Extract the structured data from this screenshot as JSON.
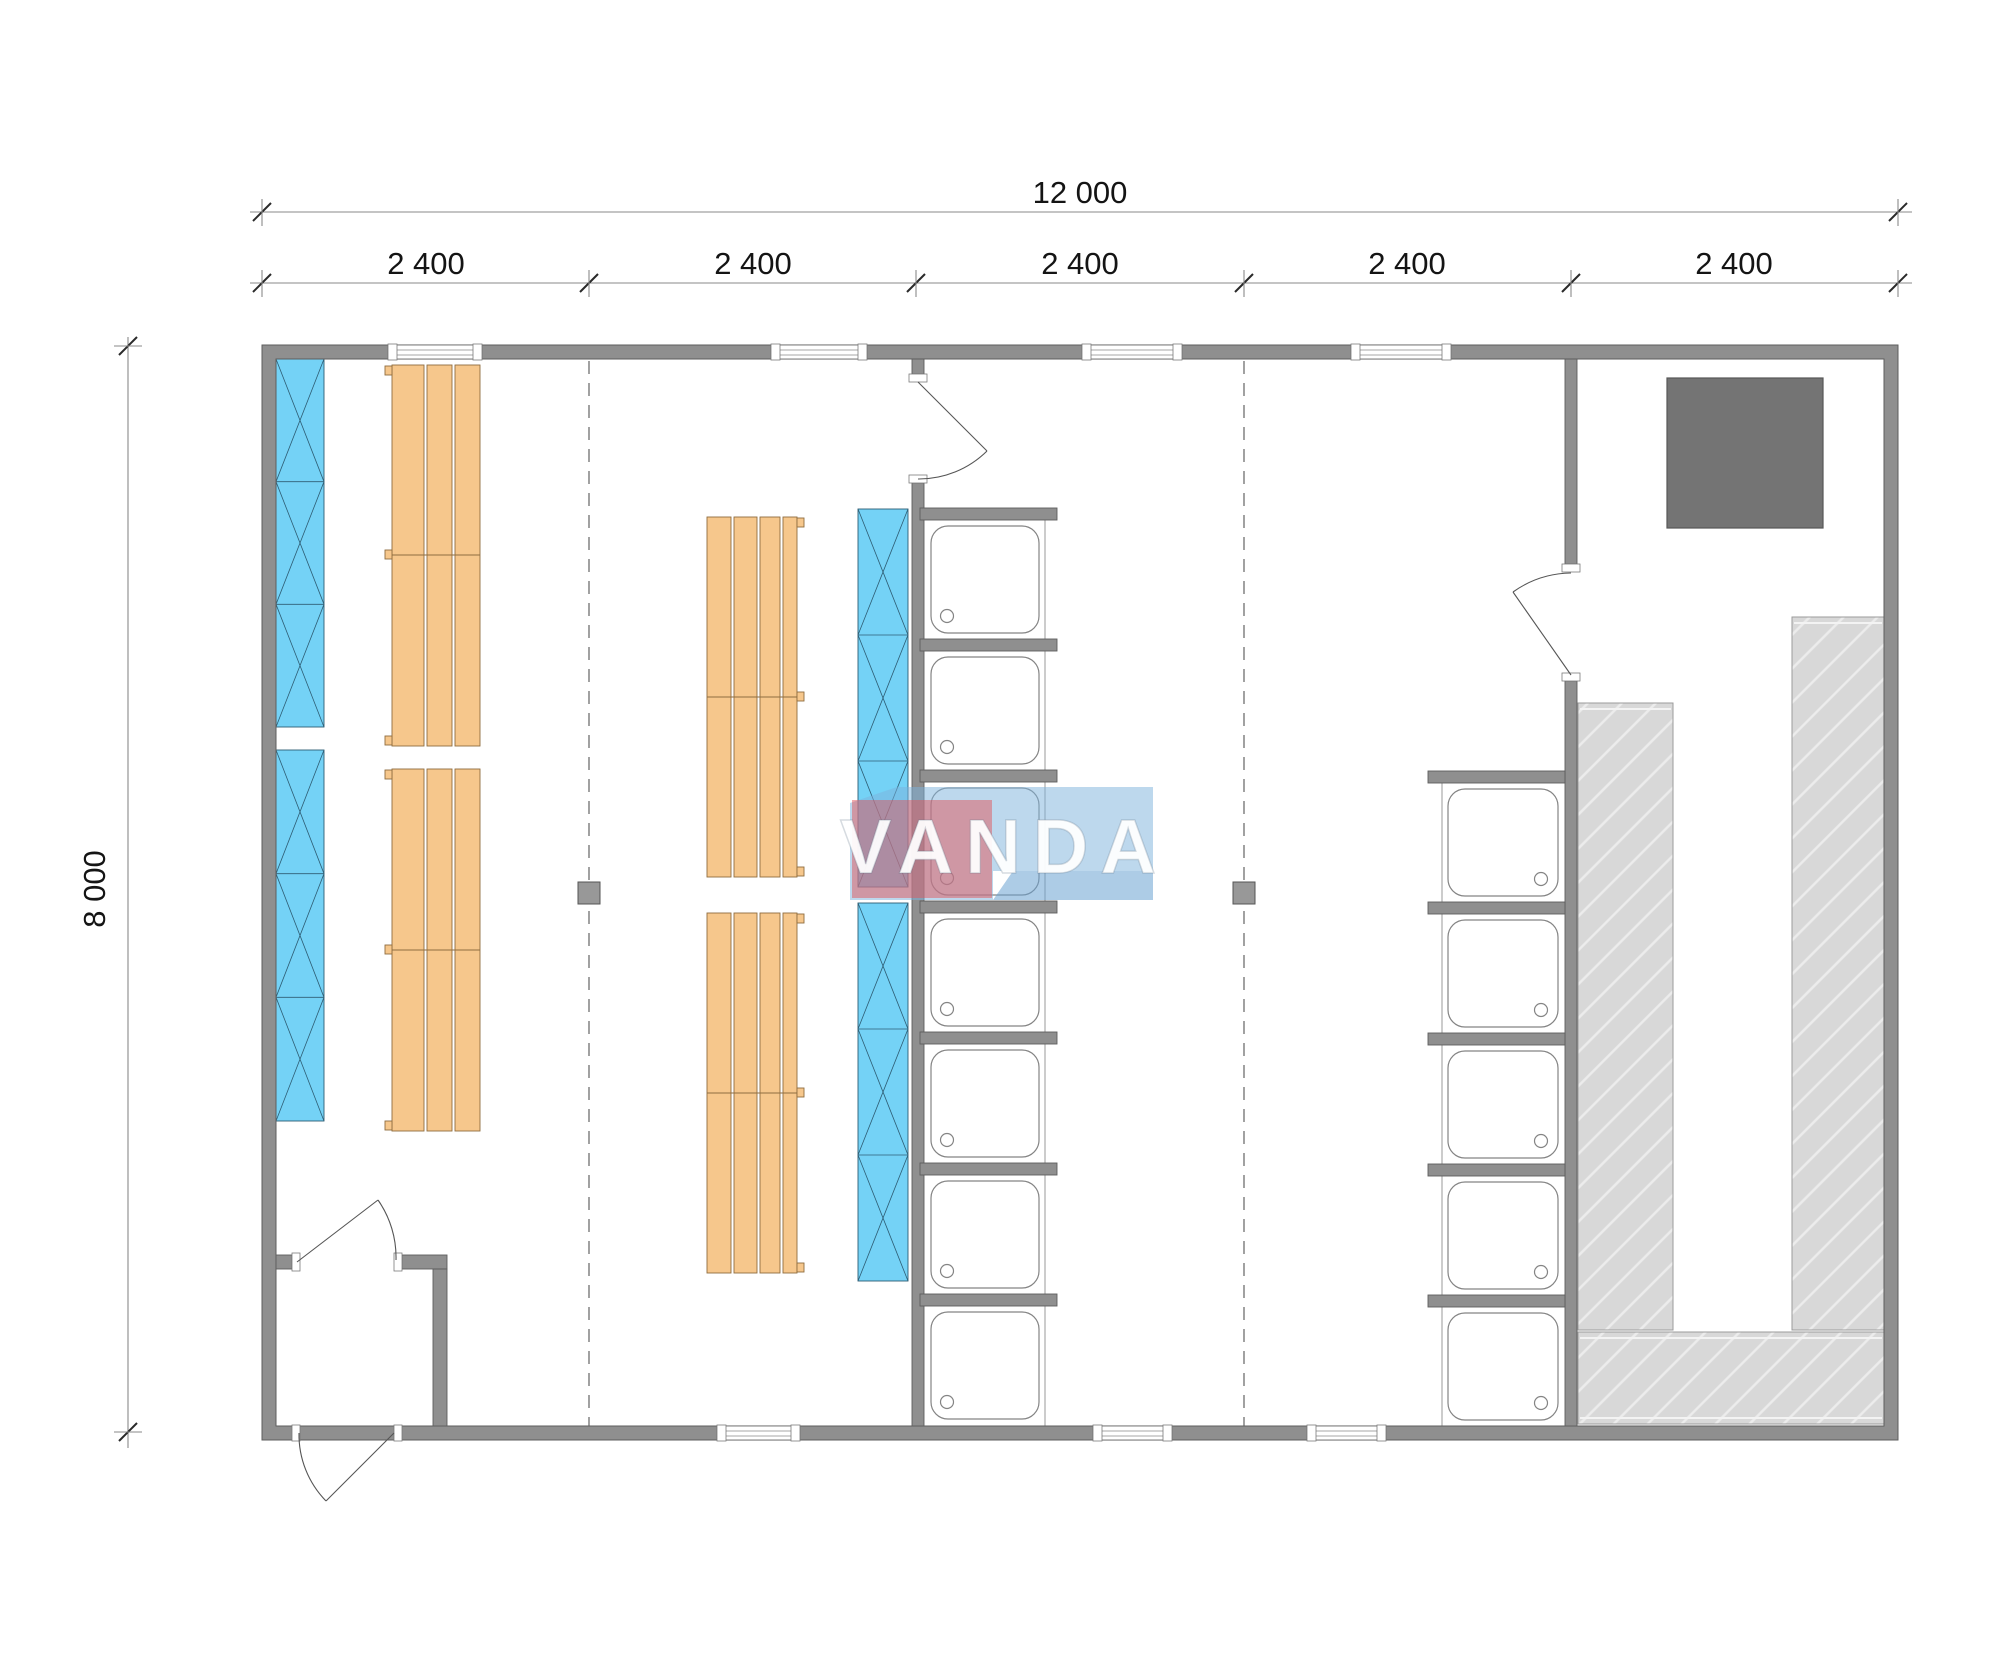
{
  "drawing": {
    "kind": "modular-sauna-floor-plan",
    "dimensions": {
      "overall_width_label": "12 000",
      "overall_height_label": "8 000",
      "module_labels": [
        "2 400",
        "2 400",
        "2 400",
        "2 400",
        "2 400"
      ]
    },
    "watermark": {
      "text": "VANDA"
    },
    "plan_elements": {
      "bench_groups": 4,
      "glazing_sections": 4,
      "shower_trays_center_column": 7,
      "shower_trays_right_column": 5,
      "stove": 1,
      "structural_posts": 2,
      "doors": 4,
      "windows_top_wall": 4,
      "windows_bottom_wall": 3
    },
    "colors": {
      "wall": "#8f8f8f",
      "bench": "#f6c78c",
      "glazing": "#74d2f6",
      "hatch_fill": "#d8d8d8",
      "stove": "#747474",
      "logo_red": "#e2555c",
      "logo_blue": "#7cb1dc"
    }
  }
}
